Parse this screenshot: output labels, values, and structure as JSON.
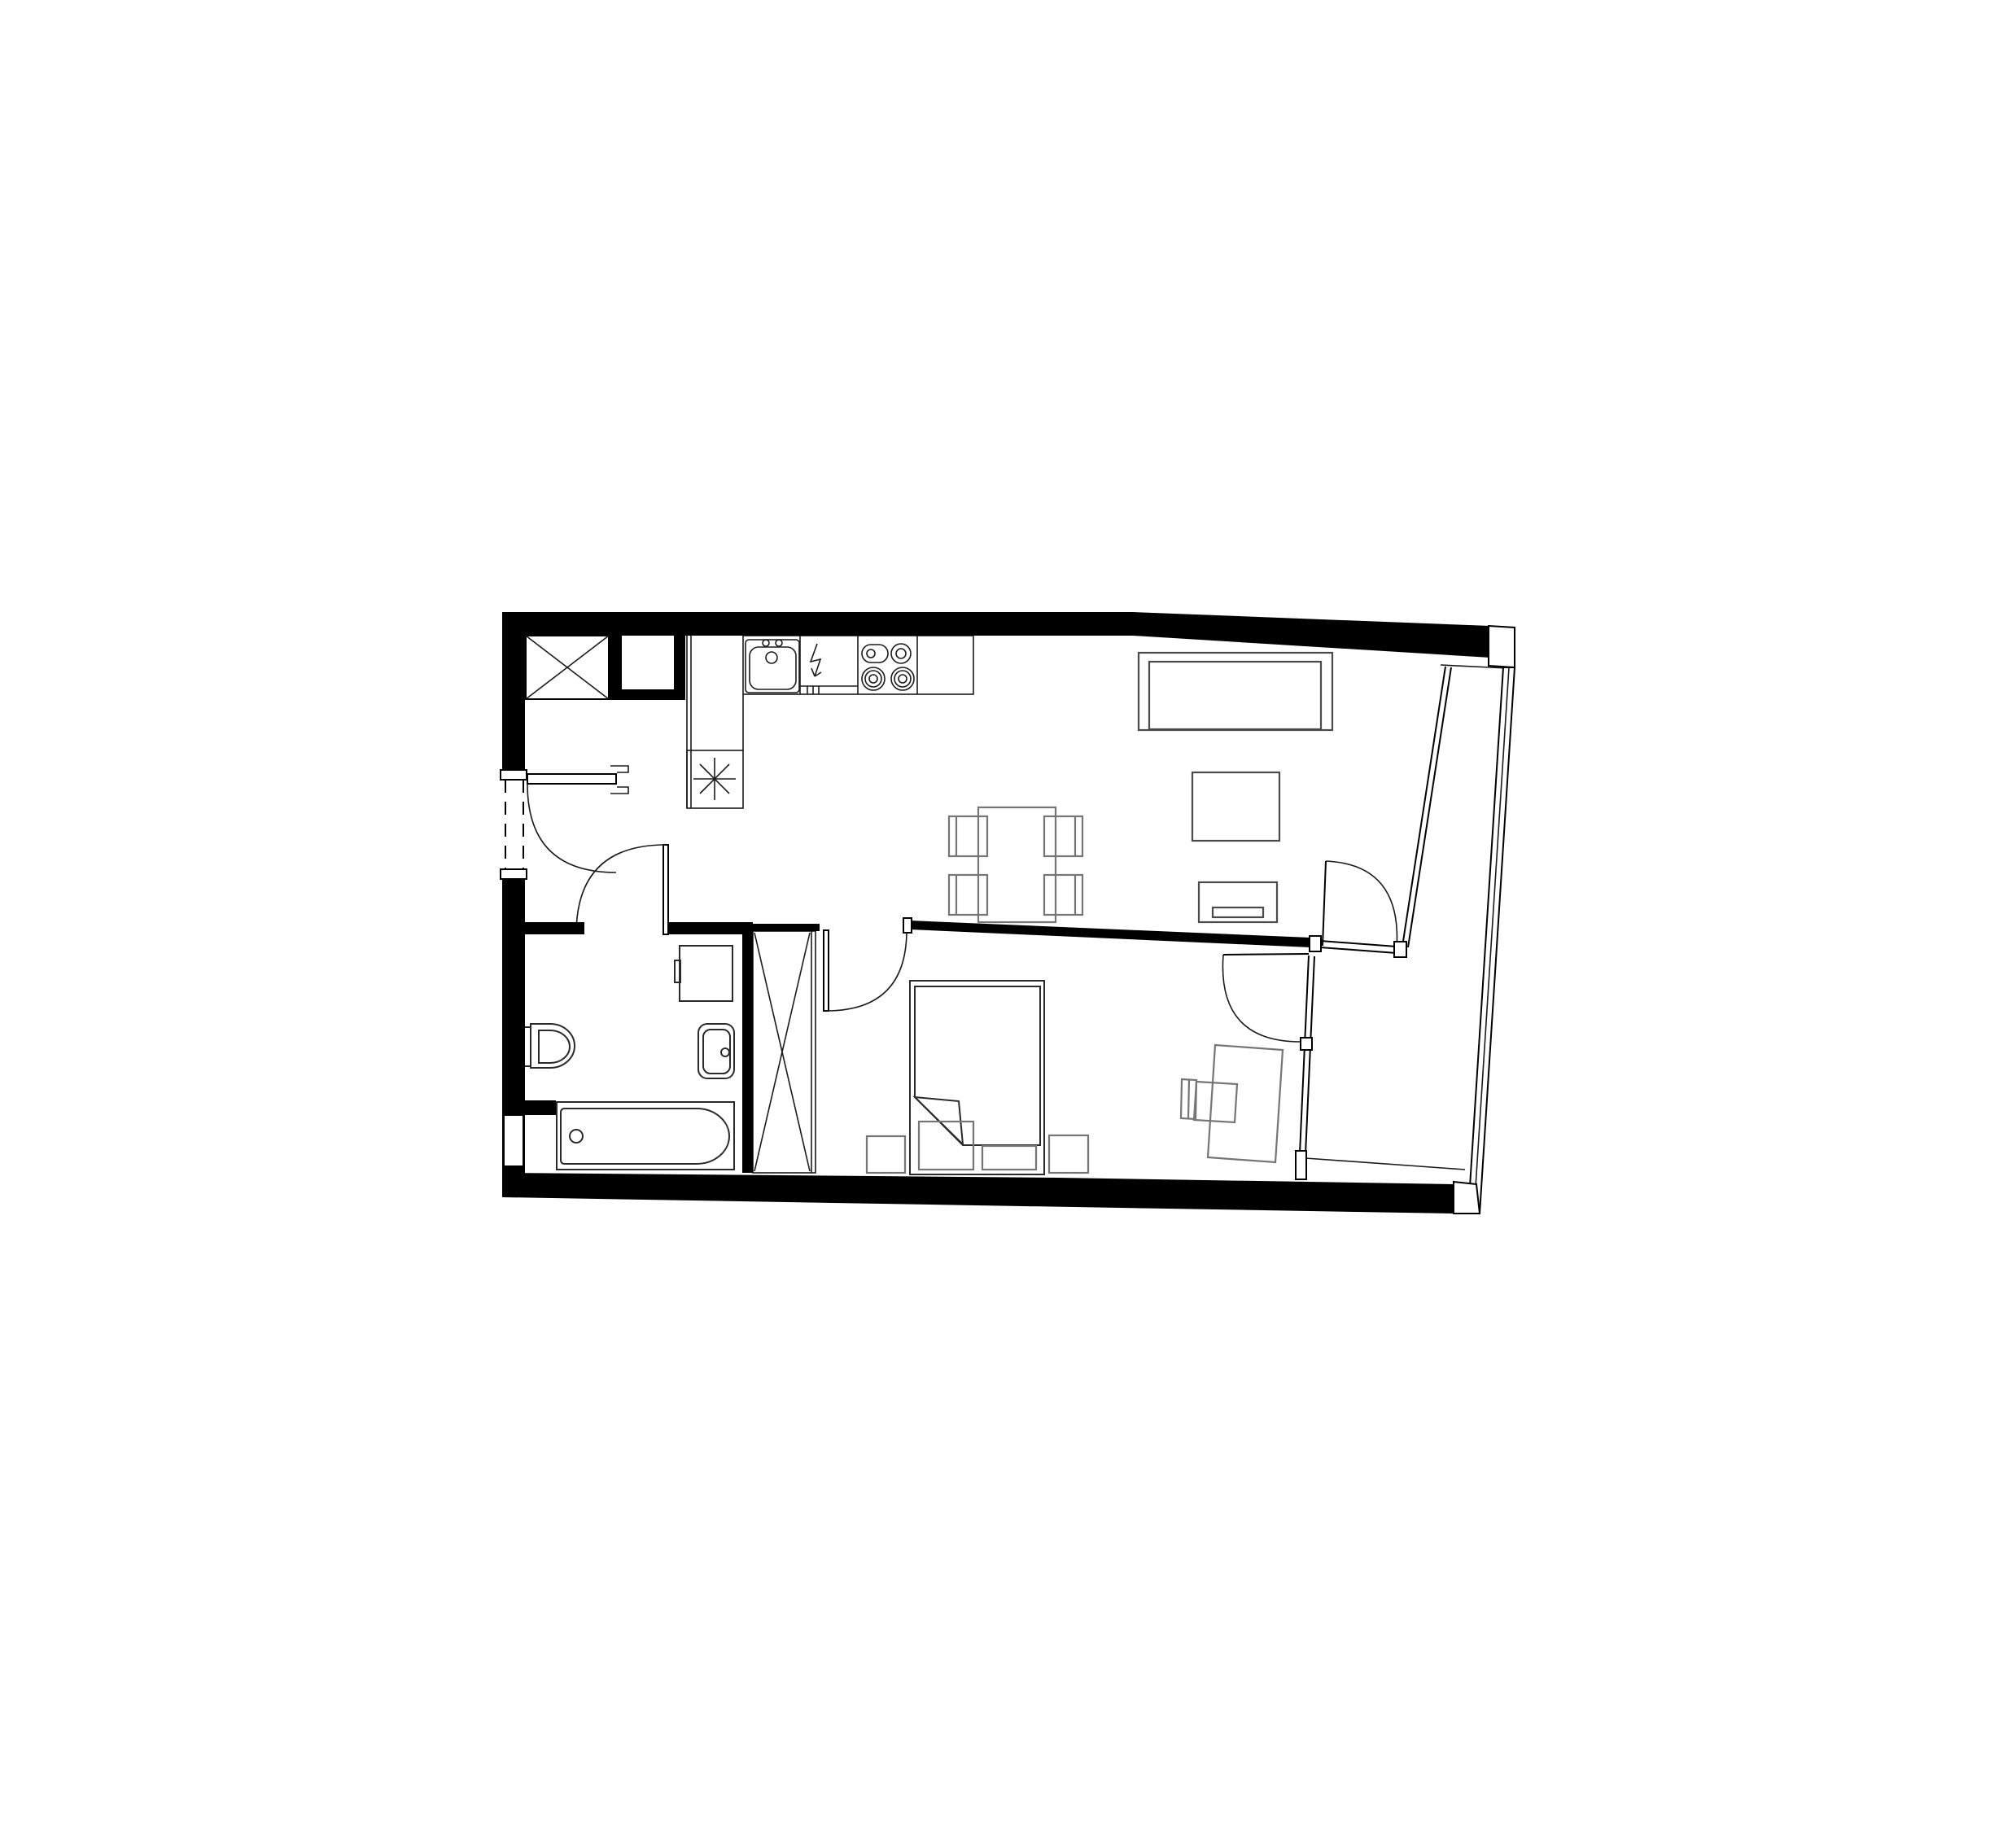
{
  "page": {
    "title": "One-bedroom apartment floor plan"
  },
  "plan": {
    "title": "One-bedroom apartment floor plan",
    "drawing_style": "black line architectural plan on white background",
    "colors": {
      "walls": "#000000",
      "architecture_lines": "#000000",
      "furniture_lines": "#4a4a4a",
      "light_furniture_lines": "#757575",
      "background": "#ffffff"
    },
    "rooms": [
      {
        "name": "entry-hall",
        "elements": [
          "entry-door-with-swing",
          "threshold-dashed-opening",
          "service-shaft-cross",
          "wall-niche"
        ]
      },
      {
        "name": "kitchen-living-room",
        "elements": [
          "kitchen-counter-run",
          "kitchen-sink",
          "electrical-outlet-arrow",
          "cooktop-4-burners",
          "dishwasher-module",
          "kitchen-return-column",
          "floor-drain-asterisk",
          "dining-table",
          "dining-chair",
          "dining-chair",
          "dining-chair",
          "dining-chair",
          "sofa",
          "coffee-table",
          "tv-stand",
          "balcony-door-with-swing",
          "glazed-window-wall"
        ]
      },
      {
        "name": "bathroom",
        "elements": [
          "toilet",
          "washing-machine",
          "washbasin",
          "bathtub",
          "bathroom-door-with-swing",
          "wall-niche-low"
        ]
      },
      {
        "name": "wardrobe-closet",
        "elements": [
          "closet-cross-symbol",
          "sliding-door-track"
        ]
      },
      {
        "name": "bedroom",
        "elements": [
          "bedroom-door-with-swing",
          "double-bed-with-folded-blanket",
          "nightstand",
          "nightstand",
          "bench-cushion",
          "bench-cushion",
          "desk",
          "desk-chair",
          "balcony-door-with-swing",
          "glazed-window-wall"
        ]
      },
      {
        "name": "balcony",
        "elements": [
          "parapet-wall",
          "corner-pier",
          "floor-edge-line"
        ]
      }
    ]
  }
}
